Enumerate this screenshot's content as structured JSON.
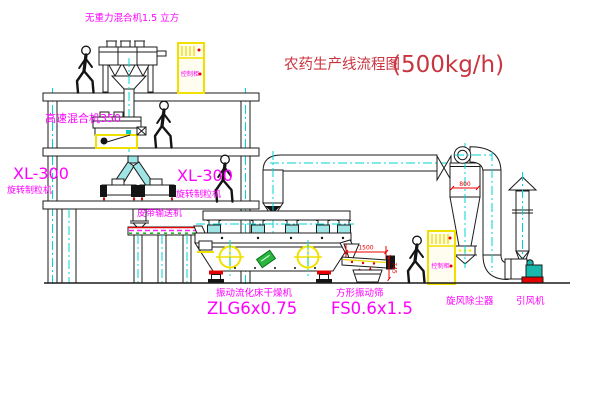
{
  "title": {
    "text": "农药生产线流程图",
    "capacity": "(500kg/h)"
  },
  "equipment": {
    "gravity_mixer": {
      "label": "无重力混合机1.5 立方"
    },
    "high_speed_mixer": {
      "label": "高速混合机350"
    },
    "granulator_left": {
      "model": "XL-300",
      "name": "旋转制粒机"
    },
    "granulator_right": {
      "model": "XL-300",
      "name": "旋转制粒机"
    },
    "belt_conveyor": {
      "name": "皮带输送机"
    },
    "fluid_bed_dryer": {
      "name": "振动流化床干燥机",
      "model": "ZLG6x0.75"
    },
    "square_sieve": {
      "name": "方形振动筛",
      "model": "FS0.6x1.5"
    },
    "cyclone": {
      "name": "旋风除尘器"
    },
    "induced_draft_fan": {
      "name": "引风机"
    },
    "control_cabinet_upper": {
      "label": "控制柜"
    },
    "control_cabinet_lower": {
      "label": "控制柜"
    }
  },
  "dimensions": {
    "cyclone_inlet": "800",
    "sieve_length": "1500",
    "sieve_height": "745"
  },
  "colors": {
    "label_magenta": "#ff00ff",
    "title_red": "#c9353f",
    "dimension_red": "#ee0000",
    "centerline_cyan": "#00d5d5",
    "cabinet_yellow": "#f0e000",
    "pipe_fill_cyan": "#9fe5e5",
    "nameplate_green": "#2ab53c",
    "fan_teal": "#19b8ae",
    "base_red": "#e30000"
  }
}
